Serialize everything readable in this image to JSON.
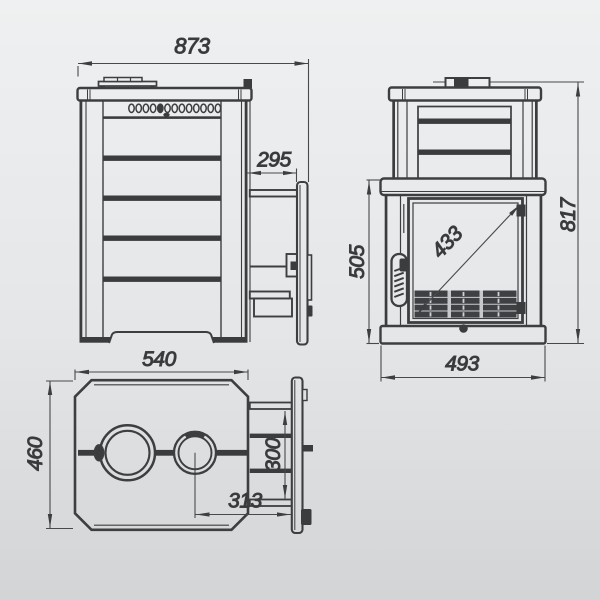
{
  "dims": {
    "side": {
      "overall_depth": "873",
      "tunnel_length": "295"
    },
    "front": {
      "overall_height": "817",
      "body_height": "505",
      "glass_diagonal": "433",
      "body_width": "493"
    },
    "top": {
      "body_depth": "540",
      "body_width": "460",
      "tunnel_width": "300",
      "flue_offset": "313"
    }
  },
  "colors": {
    "line": "#3c3e40",
    "dim_line": "#47494b",
    "text": "#35373a",
    "dark_fill": "#3a3c3e",
    "grate_fill": "#3e4043",
    "grate_line": "#c9cbcd",
    "bg_top": "#eff0f1",
    "bg_mid": "#e4e6e8",
    "bg_bottom": "#d2d4d6"
  }
}
